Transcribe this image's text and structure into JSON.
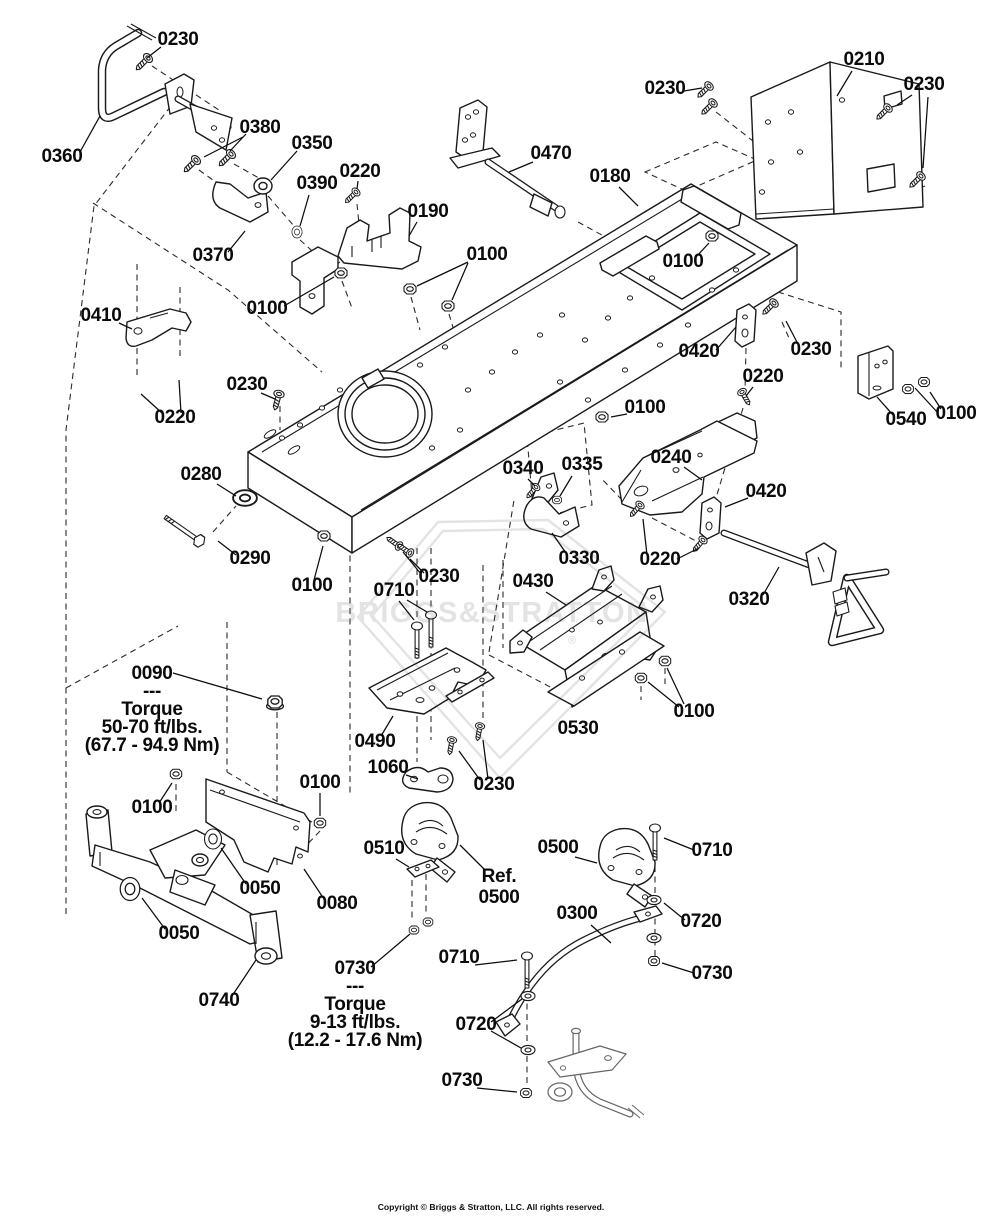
{
  "page": {
    "width": 982,
    "height": 1224,
    "background": "#ffffff",
    "line_color": "#1a1a1a"
  },
  "watermark": {
    "text": "BRIGGS&STRATTON",
    "registered": "®",
    "color": "#e3e3e3"
  },
  "footer": {
    "copyright": "Copyright © Briggs & Stratton, LLC. All rights reserved."
  },
  "diagram": {
    "labels": [
      {
        "id": "0230-a",
        "lines": [
          "0230"
        ],
        "x": 178,
        "y": 45,
        "leaders": [
          [
            161,
            47,
            147,
            58
          ]
        ]
      },
      {
        "id": "0360",
        "lines": [
          "0360"
        ],
        "x": 62,
        "y": 162,
        "leaders": [
          [
            80,
            152,
            100,
            116
          ]
        ]
      },
      {
        "id": "0380",
        "lines": [
          "0380"
        ],
        "x": 260,
        "y": 133,
        "leaders": [
          [
            243,
            137,
            204,
            157
          ],
          [
            246,
            134,
            230,
            151
          ]
        ]
      },
      {
        "id": "0350",
        "lines": [
          "0350"
        ],
        "x": 312,
        "y": 149,
        "leaders": [
          [
            297,
            151,
            271,
            180
          ]
        ]
      },
      {
        "id": "0390",
        "lines": [
          "0390"
        ],
        "x": 317,
        "y": 189,
        "leaders": [
          [
            309,
            195,
            300,
            226
          ]
        ]
      },
      {
        "id": "0220-a",
        "lines": [
          "0220"
        ],
        "x": 360,
        "y": 177,
        "leaders": [
          [
            358,
            181,
            357,
            189
          ]
        ]
      },
      {
        "id": "0190",
        "lines": [
          "0190"
        ],
        "x": 428,
        "y": 217,
        "leaders": [
          [
            417,
            222,
            409,
            236
          ]
        ]
      },
      {
        "id": "0370",
        "lines": [
          "0370"
        ],
        "x": 213,
        "y": 261,
        "leaders": [
          [
            228,
            252,
            245,
            231
          ]
        ]
      },
      {
        "id": "0470",
        "lines": [
          "0470"
        ],
        "x": 551,
        "y": 159,
        "leaders": [
          [
            533,
            162,
            509,
            172
          ]
        ]
      },
      {
        "id": "0180",
        "lines": [
          "0180"
        ],
        "x": 610,
        "y": 182,
        "leaders": [
          [
            619,
            187,
            638,
            206
          ]
        ]
      },
      {
        "id": "0210",
        "lines": [
          "0210"
        ],
        "x": 864,
        "y": 65,
        "leaders": [
          [
            852,
            71,
            837,
            96
          ]
        ]
      },
      {
        "id": "0230-b",
        "lines": [
          "0230"
        ],
        "x": 665,
        "y": 94,
        "leaders": [
          [
            684,
            91,
            702,
            88
          ]
        ]
      },
      {
        "id": "0230-c",
        "lines": [
          "0230"
        ],
        "x": 924,
        "y": 90,
        "leaders": [
          [
            912,
            95,
            897,
            105
          ],
          [
            928,
            97,
            923,
            168
          ]
        ]
      },
      {
        "id": "0100-a",
        "lines": [
          "0100"
        ],
        "x": 487,
        "y": 260,
        "leaders": [
          [
            468,
            262,
            417,
            286
          ],
          [
            468,
            263,
            452,
            300
          ]
        ]
      },
      {
        "id": "0100-b",
        "lines": [
          "0100"
        ],
        "x": 267,
        "y": 314,
        "leaders": [
          [
            284,
            306,
            334,
            277
          ]
        ]
      },
      {
        "id": "0100-c",
        "lines": [
          "0100"
        ],
        "x": 683,
        "y": 267,
        "leaders": [
          [
            696,
            257,
            709,
            243
          ]
        ]
      },
      {
        "id": "0410",
        "lines": [
          "0410"
        ],
        "x": 101,
        "y": 321,
        "leaders": [
          [
            119,
            323,
            132,
            329
          ]
        ]
      },
      {
        "id": "0220-b",
        "lines": [
          "0220"
        ],
        "x": 175,
        "y": 423,
        "leaders": [
          [
            162,
            413,
            141,
            394
          ],
          [
            181,
            413,
            179,
            380
          ]
        ]
      },
      {
        "id": "0230-d",
        "lines": [
          "0230"
        ],
        "x": 247,
        "y": 390,
        "leaders": [
          [
            261,
            393,
            275,
            399
          ]
        ]
      },
      {
        "id": "0280",
        "lines": [
          "0280"
        ],
        "x": 201,
        "y": 480,
        "leaders": [
          [
            217,
            484,
            236,
            496
          ]
        ]
      },
      {
        "id": "0290",
        "lines": [
          "0290"
        ],
        "x": 250,
        "y": 564,
        "leaders": [
          [
            236,
            555,
            218,
            541
          ]
        ]
      },
      {
        "id": "0100-d",
        "lines": [
          "0100"
        ],
        "x": 312,
        "y": 591,
        "leaders": [
          [
            314,
            580,
            323,
            546
          ]
        ]
      },
      {
        "id": "0230-e",
        "lines": [
          "0230"
        ],
        "x": 439,
        "y": 582,
        "leaders": [
          [
            424,
            573,
            410,
            559
          ],
          [
            421,
            574,
            403,
            552
          ]
        ]
      },
      {
        "id": "0710-a",
        "lines": [
          "0710"
        ],
        "x": 394,
        "y": 596,
        "leaders": [
          [
            399,
            601,
            414,
            620
          ],
          [
            407,
            600,
            427,
            612
          ]
        ]
      },
      {
        "id": "0420-a",
        "lines": [
          "0420"
        ],
        "x": 699,
        "y": 357,
        "leaders": [
          [
            716,
            350,
            736,
            327
          ]
        ]
      },
      {
        "id": "0230-f",
        "lines": [
          "0230"
        ],
        "x": 811,
        "y": 355,
        "leaders": [
          [
            799,
            346,
            786,
            321
          ]
        ]
      },
      {
        "id": "0220-c",
        "lines": [
          "0220"
        ],
        "x": 763,
        "y": 382,
        "leaders": [
          [
            753,
            387,
            746,
            396
          ]
        ]
      },
      {
        "id": "0100-e",
        "lines": [
          "0100"
        ],
        "x": 645,
        "y": 413,
        "leaders": [
          [
            627,
            414,
            611,
            417
          ]
        ]
      },
      {
        "id": "0540",
        "lines": [
          "0540"
        ],
        "x": 906,
        "y": 425,
        "leaders": [
          [
            893,
            415,
            877,
            397
          ]
        ]
      },
      {
        "id": "0100-f",
        "lines": [
          "0100"
        ],
        "x": 956,
        "y": 419,
        "leaders": [
          [
            941,
            409,
            930,
            392
          ],
          [
            938,
            413,
            915,
            388
          ]
        ]
      },
      {
        "id": "0340",
        "lines": [
          "0340"
        ],
        "x": 523,
        "y": 474,
        "leaders": [
          [
            528,
            479,
            535,
            486
          ]
        ]
      },
      {
        "id": "0335",
        "lines": [
          "0335"
        ],
        "x": 582,
        "y": 470,
        "leaders": [
          [
            572,
            476,
            560,
            496
          ]
        ]
      },
      {
        "id": "0240",
        "lines": [
          "0240"
        ],
        "x": 671,
        "y": 463,
        "leaders": [
          [
            684,
            467,
            702,
            480
          ]
        ]
      },
      {
        "id": "0420-b",
        "lines": [
          "0420"
        ],
        "x": 766,
        "y": 497,
        "leaders": [
          [
            748,
            498,
            725,
            507
          ]
        ]
      },
      {
        "id": "0330",
        "lines": [
          "0330"
        ],
        "x": 579,
        "y": 564,
        "leaders": [
          [
            566,
            553,
            552,
            533
          ]
        ]
      },
      {
        "id": "0220-d",
        "lines": [
          "0220"
        ],
        "x": 660,
        "y": 565,
        "leaders": [
          [
            647,
            555,
            643,
            519
          ],
          [
            677,
            559,
            699,
            548
          ]
        ]
      },
      {
        "id": "0320",
        "lines": [
          "0320"
        ],
        "x": 749,
        "y": 605,
        "leaders": [
          [
            763,
            595,
            779,
            567
          ]
        ]
      },
      {
        "id": "0430",
        "lines": [
          "0430"
        ],
        "x": 533,
        "y": 587,
        "leaders": [
          [
            546,
            592,
            566,
            605
          ]
        ]
      },
      {
        "id": "0530",
        "lines": [
          "0530"
        ],
        "x": 578,
        "y": 734,
        "leaders": []
      },
      {
        "id": "0100-g",
        "lines": [
          "0100"
        ],
        "x": 694,
        "y": 717,
        "leaders": [
          [
            679,
            707,
            648,
            682
          ],
          [
            684,
            704,
            667,
            668
          ]
        ]
      },
      {
        "id": "0490",
        "lines": [
          "0490"
        ],
        "x": 375,
        "y": 747,
        "leaders": [
          [
            381,
            736,
            393,
            716
          ]
        ]
      },
      {
        "id": "1060",
        "lines": [
          "1060"
        ],
        "x": 388,
        "y": 773,
        "leaders": [
          [
            406,
            775,
            418,
            779
          ]
        ]
      },
      {
        "id": "0230-g",
        "lines": [
          "0230"
        ],
        "x": 494,
        "y": 790,
        "leaders": [
          [
            480,
            780,
            459,
            751
          ],
          [
            488,
            779,
            483,
            740
          ]
        ]
      },
      {
        "id": "0100-h",
        "lines": [
          "0100"
        ],
        "x": 320,
        "y": 788,
        "leaders": [
          [
            320,
            793,
            320,
            816
          ]
        ]
      },
      {
        "id": "0100-i",
        "lines": [
          "0100"
        ],
        "x": 152,
        "y": 813,
        "leaders": [
          [
            159,
            803,
            172,
            783
          ]
        ]
      },
      {
        "id": "0050-a",
        "lines": [
          "0050"
        ],
        "x": 260,
        "y": 894,
        "leaders": [
          [
            246,
            884,
            221,
            848
          ]
        ]
      },
      {
        "id": "0080",
        "lines": [
          "0080"
        ],
        "x": 337,
        "y": 909,
        "leaders": [
          [
            324,
            899,
            304,
            869
          ]
        ]
      },
      {
        "id": "0050-b",
        "lines": [
          "0050"
        ],
        "x": 179,
        "y": 939,
        "leaders": [
          [
            165,
            929,
            142,
            898
          ]
        ]
      },
      {
        "id": "0740",
        "lines": [
          "0740"
        ],
        "x": 219,
        "y": 1006,
        "leaders": [
          [
            232,
            996,
            256,
            960
          ]
        ]
      },
      {
        "id": "0510",
        "lines": [
          "0510"
        ],
        "x": 384,
        "y": 854,
        "leaders": [
          [
            396,
            859,
            409,
            867
          ]
        ]
      },
      {
        "id": "ref-0500",
        "lines": [
          "Ref.",
          "0500"
        ],
        "x": 499,
        "y": 882,
        "lh": 21,
        "leaders": [
          [
            485,
            870,
            460,
            845
          ]
        ]
      },
      {
        "id": "0500",
        "lines": [
          "0500"
        ],
        "x": 558,
        "y": 853,
        "leaders": [
          [
            575,
            857,
            597,
            863
          ]
        ]
      },
      {
        "id": "0710-b",
        "lines": [
          "0710"
        ],
        "x": 712,
        "y": 856,
        "leaders": [
          [
            694,
            850,
            664,
            838
          ]
        ]
      },
      {
        "id": "0300",
        "lines": [
          "0300"
        ],
        "x": 577,
        "y": 919,
        "leaders": [
          [
            591,
            925,
            611,
            943
          ]
        ]
      },
      {
        "id": "0720-a",
        "lines": [
          "0720"
        ],
        "x": 701,
        "y": 927,
        "leaders": [
          [
            685,
            920,
            664,
            903
          ]
        ]
      },
      {
        "id": "0730-a",
        "lines": [
          "0730"
        ],
        "x": 712,
        "y": 979,
        "leaders": [
          [
            694,
            973,
            662,
            963
          ]
        ]
      },
      {
        "id": "0710-c",
        "lines": [
          "0710"
        ],
        "x": 459,
        "y": 963,
        "leaders": [
          [
            475,
            965,
            517,
            960
          ]
        ]
      },
      {
        "id": "0720-b",
        "lines": [
          "0720"
        ],
        "x": 476,
        "y": 1030,
        "leaders": [
          [
            491,
            1022,
            522,
            999
          ],
          [
            491,
            1031,
            521,
            1048
          ]
        ]
      },
      {
        "id": "0730-b",
        "lines": [
          "0730"
        ],
        "x": 462,
        "y": 1086,
        "leaders": [
          [
            477,
            1088,
            517,
            1092
          ]
        ]
      },
      {
        "id": "note-0090",
        "lines": [
          "0090",
          "---",
          "Torque",
          "50-70 ft/lbs.",
          "(67.7 - 94.9 Nm)"
        ],
        "x": 152,
        "y": 679,
        "lh": 18,
        "leaders": [
          [
            173,
            673,
            262,
            699
          ]
        ]
      },
      {
        "id": "note-0730",
        "lines": [
          "0730",
          "---",
          "Torque",
          "9-13 ft/lbs.",
          "(12.2 - 17.6 Nm)"
        ],
        "x": 355,
        "y": 974,
        "lh": 18,
        "leaders": [
          [
            371,
            967,
            410,
            934
          ]
        ]
      }
    ]
  }
}
